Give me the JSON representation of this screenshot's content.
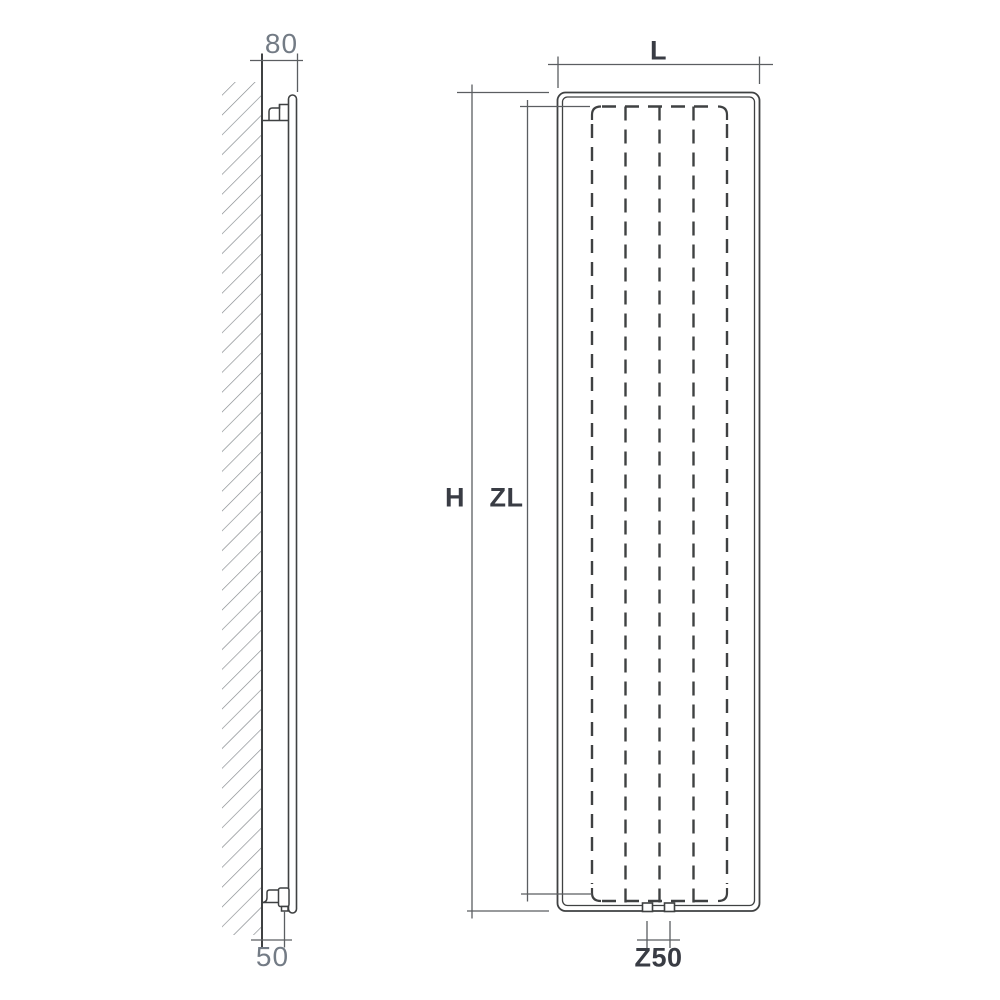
{
  "drawing": {
    "colors": {
      "background": "#ffffff",
      "line": "#3f4142",
      "dimension_line": "#5b5e61",
      "hatch": "#83878b",
      "label_light": "#737b85",
      "label_dark": "#393c44"
    },
    "side_view": {
      "dim_depth_label": "80",
      "dim_pipe_offset_label": "50"
    },
    "front_view": {
      "dim_width_label": "L",
      "dim_height_label": "H",
      "dim_inner_height_label": "ZL",
      "dim_connection_spacing_label": "Z50"
    }
  }
}
